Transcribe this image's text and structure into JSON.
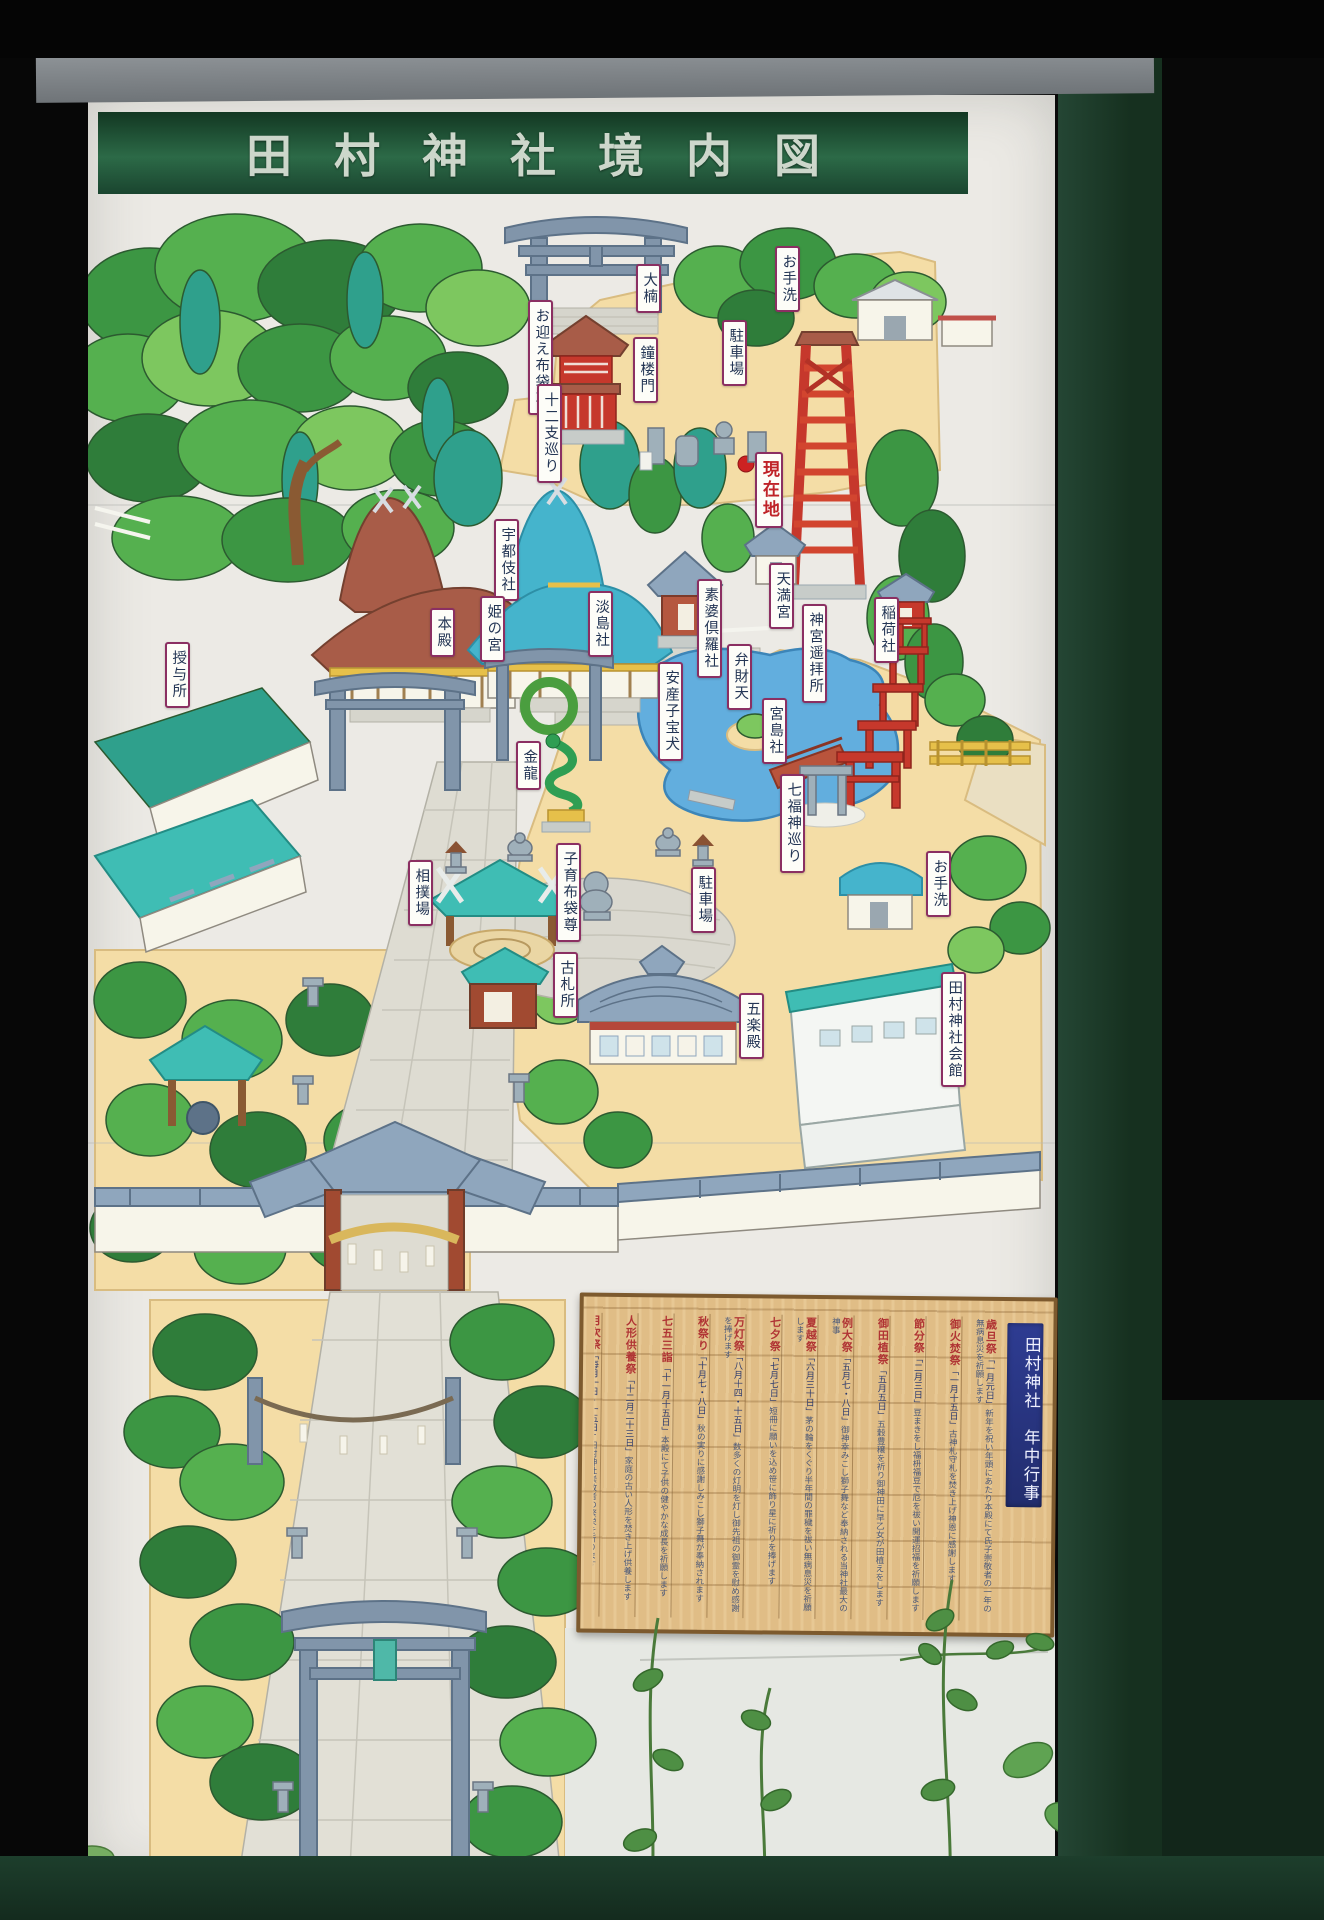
{
  "sign": {
    "title": "田村神社境内図"
  },
  "map": {
    "labels": [
      {
        "id": "okusu",
        "text": "大楠",
        "x": 636,
        "y": 264
      },
      {
        "id": "otearai-north",
        "text": "お手洗",
        "x": 775,
        "y": 246
      },
      {
        "id": "chushajo-north",
        "text": "駐車場",
        "x": 722,
        "y": 320
      },
      {
        "id": "shoromon",
        "text": "鐘楼門",
        "x": 633,
        "y": 337
      },
      {
        "id": "omukae-hoteison",
        "text": "お迎え布袋尊",
        "x": 528,
        "y": 300
      },
      {
        "id": "junishi-meguri",
        "text": "十二支巡り",
        "x": 537,
        "y": 384
      },
      {
        "id": "genzaichi",
        "text": "現在地",
        "x": 755,
        "y": 452,
        "accent": true
      },
      {
        "id": "utsuki-sha",
        "text": "宇都伎社",
        "x": 494,
        "y": 519
      },
      {
        "id": "hime-no-miya",
        "text": "姫の宮",
        "x": 480,
        "y": 596
      },
      {
        "id": "honden",
        "text": "本殿",
        "x": 430,
        "y": 608
      },
      {
        "id": "awashima-sha",
        "text": "淡島社",
        "x": 588,
        "y": 591
      },
      {
        "id": "subakura-sha",
        "text": "素婆倶羅社",
        "x": 697,
        "y": 579
      },
      {
        "id": "tenmangu",
        "text": "天満宮",
        "x": 769,
        "y": 563
      },
      {
        "id": "jingu-yohaisho",
        "text": "神宮遥拝所",
        "x": 802,
        "y": 604
      },
      {
        "id": "inari-sha",
        "text": "稲荷社",
        "x": 874,
        "y": 597
      },
      {
        "id": "benzaiten",
        "text": "弁財天",
        "x": 727,
        "y": 644
      },
      {
        "id": "anzan-kodakara-inu",
        "text": "安産子宝犬",
        "x": 658,
        "y": 662
      },
      {
        "id": "miyajima-sha",
        "text": "宮島社",
        "x": 762,
        "y": 698
      },
      {
        "id": "shichifukujin-meguri",
        "text": "七福神巡り",
        "x": 780,
        "y": 774
      },
      {
        "id": "juyosho",
        "text": "授与所",
        "x": 165,
        "y": 642
      },
      {
        "id": "kinryu",
        "text": "金龍",
        "x": 516,
        "y": 741
      },
      {
        "id": "sumo-ba",
        "text": "相撲場",
        "x": 408,
        "y": 860
      },
      {
        "id": "kosodate-hoteison",
        "text": "子育布袋尊",
        "x": 556,
        "y": 843
      },
      {
        "id": "chushajo-center",
        "text": "駐車場",
        "x": 691,
        "y": 867
      },
      {
        "id": "otearai-east",
        "text": "お手洗",
        "x": 926,
        "y": 851
      },
      {
        "id": "kofudasho",
        "text": "古札所",
        "x": 553,
        "y": 952
      },
      {
        "id": "gorakuden",
        "text": "五楽殿",
        "x": 739,
        "y": 993
      },
      {
        "id": "tamura-jinja-kaikan",
        "text": "田村神社会館",
        "x": 941,
        "y": 972
      }
    ]
  },
  "events_board": {
    "title": "田村神社　年中行事",
    "columns": [
      {
        "name": "歳旦祭",
        "date": "一月元日",
        "desc": "新年を祝い年頭にあたり本殿にて氏子崇敬者の一年の無病息災を祈願します"
      },
      {
        "name": "御火焚祭",
        "date": "一月十五日",
        "desc": "古神札守札を焚き上げ神恩に感謝します"
      },
      {
        "name": "節分祭",
        "date": "二月三日",
        "desc": "豆まきをし福枡福豆で厄を祓い開運招福を祈願します"
      },
      {
        "name": "御田植祭",
        "date": "五月五日",
        "desc": "五穀豊穣を祈り御神田に早乙女が田植えをします"
      },
      {
        "name": "例大祭",
        "date": "五月七・八日",
        "desc": "御神幸みこし獅子舞など奉納される当神社最大の神事"
      },
      {
        "name": "夏越祭",
        "date": "六月三十日",
        "desc": "茅の輪をくぐり半年間の罪穢を祓い無病息災を祈願します"
      },
      {
        "name": "七夕祭",
        "date": "七月七日",
        "desc": "短冊に願いを込め笹に飾り星に祈りを捧げます"
      },
      {
        "name": "万灯祭",
        "date": "八月十四・十五日",
        "desc": "数多くの灯明を灯し御先祖の御霊を慰め感謝を捧げます"
      },
      {
        "name": "秋祭り",
        "date": "十月七・八日",
        "desc": "秋の実りに感謝しみこし獅子舞が奉納されます"
      },
      {
        "name": "七五三詣",
        "date": "十一月十五日",
        "desc": "本殿にて子供の健やかな成長を祈願します"
      },
      {
        "name": "人形供養祭",
        "date": "十二月二十三日",
        "desc": "家庭の古い人形を焚き上げ供養します"
      },
      {
        "name": "月次祭",
        "date": "毎月一日・十五日",
        "desc": "田村神社崇敬者の繁栄を祈ります"
      }
    ]
  }
}
